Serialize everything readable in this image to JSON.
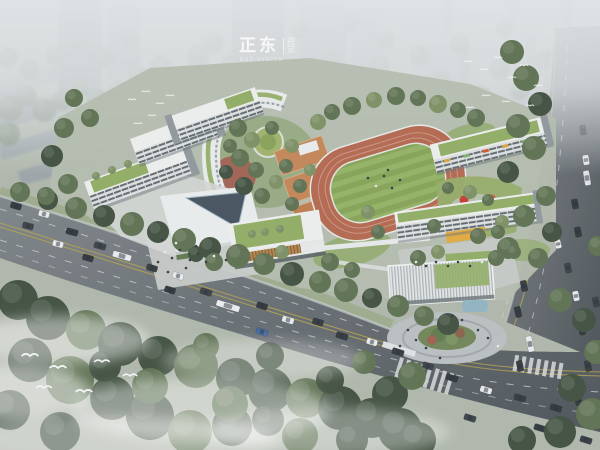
{
  "watermark": {
    "brand": "正东",
    "vertical": "视觉",
    "subtext": "EST VISION"
  },
  "palette": {
    "sky": "#c3cacd",
    "fog": "#e0e4e7",
    "ground": "#aeb6aa",
    "plinth": "#b4bcae",
    "road": "#7d8488",
    "roadDark": "#4b5257",
    "laneYellow": "#b7a14c",
    "laneWhite": "#cdd2d3",
    "trackRed": "#b4674f",
    "fieldGreenA": "#84a355",
    "fieldGreenB": "#93b165",
    "courtOrange": "#c28455",
    "roofGreen": "#8fac63",
    "buildingWhite": "#eceeee",
    "facadeShade": "#aab2b6",
    "windowDark": "#5f686e",
    "treeLight": "#7b8f62",
    "treeMid": "#5c7050",
    "treeDark": "#3f4f3f",
    "treeHaze": "#828e7e",
    "forest": "#42513e",
    "plazaRed": "#a3554b",
    "woodLouver": "#b5854c",
    "canopyYellow": "#e2a93e",
    "pondBlue": "#8fb3c2",
    "cityGrey": "#9aa2a7",
    "plaza": "#c3c8c7",
    "accentRed": "#c23b30"
  },
  "scene": {
    "trees_bg": [
      [
        10,
        108,
        13
      ],
      [
        26,
        96,
        11
      ],
      [
        44,
        110,
        12
      ],
      [
        8,
        134,
        12
      ],
      [
        62,
        100,
        10
      ],
      [
        80,
        88,
        10
      ],
      [
        98,
        100,
        11
      ],
      [
        118,
        90,
        10
      ],
      [
        140,
        78,
        11
      ],
      [
        160,
        66,
        10
      ],
      [
        178,
        84,
        10
      ],
      [
        198,
        56,
        11
      ],
      [
        214,
        44,
        10
      ],
      [
        232,
        64,
        10
      ],
      [
        252,
        40,
        9
      ],
      [
        270,
        56,
        9
      ],
      [
        300,
        72,
        10
      ],
      [
        330,
        60,
        10
      ],
      [
        355,
        84,
        10
      ],
      [
        380,
        66,
        10
      ],
      [
        400,
        90,
        11
      ],
      [
        420,
        56,
        10
      ],
      [
        440,
        80,
        10
      ],
      [
        300,
        30,
        9
      ],
      [
        350,
        22,
        9
      ],
      [
        460,
        44,
        10
      ],
      [
        480,
        96,
        11
      ],
      [
        500,
        70,
        10
      ],
      [
        520,
        90,
        10
      ],
      [
        545,
        60,
        10
      ],
      [
        250,
        90,
        10
      ],
      [
        225,
        100,
        10
      ],
      [
        130,
        40,
        9
      ],
      [
        105,
        58,
        10
      ],
      [
        80,
        40,
        9
      ],
      [
        55,
        56,
        9
      ],
      [
        30,
        70,
        10
      ],
      [
        8,
        58,
        10
      ],
      [
        385,
        40,
        9
      ],
      [
        505,
        28,
        9
      ],
      [
        596,
        140,
        10
      ],
      [
        592,
        176,
        10
      ]
    ],
    "trees": [
      [
        18,
        300,
        20,
        2
      ],
      [
        48,
        318,
        22,
        2
      ],
      [
        86,
        330,
        20,
        1
      ],
      [
        120,
        344,
        22,
        2
      ],
      [
        158,
        356,
        20,
        2
      ],
      [
        196,
        366,
        22,
        1
      ],
      [
        236,
        378,
        20,
        2
      ],
      [
        270,
        390,
        22,
        2
      ],
      [
        306,
        398,
        20,
        1
      ],
      [
        340,
        408,
        22,
        2
      ],
      [
        372,
        418,
        20,
        2
      ],
      [
        400,
        430,
        22,
        2
      ],
      [
        30,
        360,
        22,
        2
      ],
      [
        70,
        380,
        24,
        1
      ],
      [
        112,
        398,
        22,
        2
      ],
      [
        150,
        416,
        24,
        2
      ],
      [
        190,
        432,
        22,
        1
      ],
      [
        10,
        410,
        20,
        2
      ],
      [
        60,
        432,
        20,
        2
      ],
      [
        232,
        426,
        20,
        2
      ],
      [
        300,
        436,
        18,
        1
      ],
      [
        352,
        440,
        16,
        2
      ],
      [
        390,
        394,
        18,
        2
      ],
      [
        412,
        376,
        14,
        1
      ],
      [
        150,
        386,
        18,
        1
      ],
      [
        105,
        366,
        16,
        2
      ],
      [
        230,
        404,
        18,
        1
      ],
      [
        268,
        420,
        16,
        2
      ],
      [
        330,
        380,
        14,
        2
      ],
      [
        364,
        362,
        12,
        1
      ],
      [
        418,
        440,
        18,
        2
      ],
      [
        270,
        356,
        14,
        2
      ],
      [
        206,
        346,
        13,
        1
      ],
      [
        20,
        192,
        10,
        1
      ],
      [
        48,
        200,
        10,
        2
      ],
      [
        76,
        208,
        11,
        1
      ],
      [
        104,
        216,
        11,
        2
      ],
      [
        132,
        224,
        12,
        1
      ],
      [
        158,
        232,
        11,
        2
      ],
      [
        184,
        240,
        12,
        1
      ],
      [
        210,
        248,
        11,
        2
      ],
      [
        238,
        256,
        12,
        1
      ],
      [
        264,
        264,
        11,
        1
      ],
      [
        292,
        274,
        12,
        2
      ],
      [
        320,
        282,
        11,
        1
      ],
      [
        346,
        290,
        12,
        1
      ],
      [
        372,
        298,
        10,
        2
      ],
      [
        398,
        306,
        11,
        1
      ],
      [
        424,
        316,
        10,
        1
      ],
      [
        448,
        324,
        11,
        2
      ],
      [
        512,
        52,
        12,
        1
      ],
      [
        526,
        78,
        13,
        1
      ],
      [
        540,
        104,
        12,
        2
      ],
      [
        518,
        126,
        12,
        1
      ],
      [
        534,
        148,
        12,
        1
      ],
      [
        508,
        172,
        11,
        2
      ],
      [
        546,
        196,
        10,
        1
      ],
      [
        524,
        216,
        11,
        1
      ],
      [
        552,
        232,
        10,
        2
      ],
      [
        508,
        248,
        11,
        1
      ],
      [
        538,
        258,
        10,
        1
      ],
      [
        560,
        300,
        12,
        1
      ],
      [
        584,
        320,
        12,
        2
      ],
      [
        596,
        352,
        12,
        1
      ],
      [
        572,
        388,
        14,
        2
      ],
      [
        592,
        414,
        16,
        1
      ],
      [
        560,
        432,
        16,
        2
      ],
      [
        522,
        440,
        14,
        2
      ],
      [
        598,
        246,
        10,
        1
      ],
      [
        332,
        112,
        8,
        1
      ],
      [
        352,
        106,
        9,
        1
      ],
      [
        374,
        100,
        8,
        0
      ],
      [
        396,
        96,
        9,
        1
      ],
      [
        418,
        98,
        8,
        1
      ],
      [
        438,
        104,
        9,
        0
      ],
      [
        458,
        110,
        8,
        1
      ],
      [
        476,
        118,
        9,
        1
      ],
      [
        318,
        122,
        8,
        0
      ],
      [
        238,
        128,
        9,
        1
      ],
      [
        252,
        140,
        8,
        0
      ],
      [
        240,
        158,
        9,
        1
      ],
      [
        256,
        170,
        8,
        1
      ],
      [
        244,
        186,
        9,
        2
      ],
      [
        262,
        196,
        8,
        1
      ],
      [
        276,
        182,
        7,
        0
      ],
      [
        286,
        166,
        7,
        1
      ],
      [
        272,
        128,
        7,
        1
      ],
      [
        292,
        146,
        7,
        0
      ],
      [
        300,
        186,
        7,
        1
      ],
      [
        310,
        170,
        6,
        0
      ],
      [
        292,
        204,
        7,
        1
      ],
      [
        230,
        146,
        7,
        1
      ],
      [
        226,
        172,
        7,
        2
      ],
      [
        214,
        262,
        9,
        1
      ],
      [
        196,
        254,
        8,
        2
      ],
      [
        330,
        262,
        9,
        1
      ],
      [
        352,
        270,
        8,
        1
      ],
      [
        282,
        252,
        7,
        0
      ],
      [
        418,
        258,
        8,
        1
      ],
      [
        438,
        252,
        7,
        0
      ],
      [
        496,
        258,
        8,
        1
      ],
      [
        514,
        252,
        7,
        1
      ],
      [
        470,
        192,
        7,
        0
      ],
      [
        448,
        188,
        6,
        1
      ],
      [
        488,
        200,
        6,
        1
      ],
      [
        502,
        222,
        7,
        0
      ],
      [
        434,
        226,
        7,
        1
      ],
      [
        378,
        232,
        7,
        1
      ],
      [
        368,
        212,
        7,
        0
      ],
      [
        478,
        236,
        8,
        1
      ],
      [
        498,
        232,
        7,
        1
      ],
      [
        64,
        128,
        10,
        1
      ],
      [
        52,
        156,
        11,
        2
      ],
      [
        68,
        184,
        10,
        1
      ],
      [
        46,
        196,
        9,
        1
      ],
      [
        90,
        118,
        9,
        1
      ],
      [
        74,
        98,
        9,
        1
      ],
      [
        96,
        176,
        4,
        0
      ],
      [
        112,
        170,
        4,
        0
      ],
      [
        128,
        164,
        4,
        0
      ],
      [
        265,
        232,
        4,
        0
      ],
      [
        280,
        229,
        4,
        0
      ],
      [
        252,
        234,
        4,
        0
      ]
    ],
    "cars_far": [
      [
        583,
        130,
        10,
        82,
        "#3a4046"
      ],
      [
        586,
        160,
        10,
        81,
        "#e8eaec"
      ],
      [
        587,
        178,
        15,
        81,
        "#dfe3e5"
      ]
    ],
    "cars": [
      [
        16,
        206,
        11,
        15,
        "#2f353a"
      ],
      [
        44,
        214,
        11,
        15,
        "#e8eaec"
      ],
      [
        28,
        226,
        11,
        15,
        "#3a4046"
      ],
      [
        72,
        232,
        12,
        15,
        "#2f353a"
      ],
      [
        58,
        244,
        11,
        15,
        "#e8eaec"
      ],
      [
        100,
        246,
        12,
        16,
        "#3a4046"
      ],
      [
        88,
        258,
        11,
        16,
        "#2f353a"
      ],
      [
        122,
        256,
        19,
        16,
        "#e9ebec"
      ],
      [
        152,
        268,
        11,
        17,
        "#33393e"
      ],
      [
        178,
        276,
        11,
        17,
        "#e8eaec"
      ],
      [
        170,
        290,
        11,
        17,
        "#2f353a"
      ],
      [
        206,
        292,
        12,
        17,
        "#3a4046"
      ],
      [
        228,
        306,
        24,
        17,
        "#eceeef"
      ],
      [
        262,
        306,
        11,
        17,
        "#2f353a"
      ],
      [
        288,
        320,
        12,
        17,
        "#e8eaec"
      ],
      [
        262,
        332,
        12,
        17,
        "#3f65a0"
      ],
      [
        318,
        322,
        11,
        17,
        "#33393e"
      ],
      [
        342,
        336,
        12,
        17,
        "#2f353a"
      ],
      [
        372,
        342,
        11,
        17,
        "#e8eaec"
      ],
      [
        398,
        352,
        12,
        17,
        "#33393e"
      ],
      [
        368,
        364,
        12,
        17,
        "#2f353a"
      ],
      [
        428,
        366,
        11,
        17,
        "#3a4046"
      ],
      [
        452,
        378,
        12,
        18,
        "#2f353a"
      ],
      [
        486,
        390,
        12,
        18,
        "#e8eaec"
      ],
      [
        520,
        398,
        12,
        18,
        "#33393e"
      ],
      [
        556,
        408,
        12,
        18,
        "#2f353a"
      ],
      [
        470,
        418,
        12,
        18,
        "#3a4046"
      ],
      [
        540,
        428,
        12,
        18,
        "#2f353a"
      ],
      [
        586,
        440,
        12,
        18,
        "#33393e"
      ],
      [
        524,
        286,
        11,
        78,
        "#33393e"
      ],
      [
        518,
        312,
        11,
        78,
        "#2f353a"
      ],
      [
        530,
        344,
        16,
        78,
        "#e9ebec"
      ],
      [
        520,
        366,
        11,
        78,
        "#33393e"
      ],
      [
        568,
        268,
        10,
        79,
        "#3a4046"
      ],
      [
        576,
        296,
        10,
        79,
        "#e8eaec"
      ],
      [
        582,
        330,
        10,
        78,
        "#2f353a"
      ],
      [
        588,
        366,
        11,
        78,
        "#33393e"
      ],
      [
        578,
        400,
        11,
        77,
        "#2f353a"
      ],
      [
        596,
        302,
        10,
        78,
        "#3a4046"
      ],
      [
        575,
        204,
        10,
        80,
        "#32383d"
      ],
      [
        578,
        232,
        10,
        79,
        "#2f353a"
      ],
      [
        558,
        244,
        9,
        76,
        "#e8eaec"
      ]
    ],
    "birds": [
      [
        132,
        100,
        0.7
      ],
      [
        146,
        92,
        0.7
      ],
      [
        160,
        104,
        0.7
      ],
      [
        170,
        96,
        0.7
      ],
      [
        152,
        116,
        0.7
      ],
      [
        138,
        124,
        0.7
      ],
      [
        468,
        62,
        0.7
      ],
      [
        484,
        70,
        0.7
      ],
      [
        498,
        58,
        0.7
      ],
      [
        512,
        78,
        0.7
      ],
      [
        524,
        66,
        0.7
      ],
      [
        538,
        86,
        0.7
      ],
      [
        486,
        96,
        0.7
      ],
      [
        506,
        102,
        0.7
      ],
      [
        470,
        108,
        0.7
      ],
      [
        530,
        106,
        0.7
      ],
      [
        30,
        356,
        1.4
      ],
      [
        58,
        368,
        1.4
      ],
      [
        102,
        362,
        1.3
      ],
      [
        84,
        392,
        1.4
      ],
      [
        130,
        376,
        1.2
      ],
      [
        44,
        388,
        1.3
      ]
    ],
    "people": [
      [
        165,
        252
      ],
      [
        172,
        258
      ],
      [
        180,
        250
      ],
      [
        190,
        260
      ],
      [
        198,
        254
      ],
      [
        206,
        262
      ],
      [
        214,
        256
      ],
      [
        158,
        262
      ],
      [
        186,
        268
      ],
      [
        226,
        260
      ],
      [
        150,
        270
      ],
      [
        168,
        272
      ],
      [
        416,
        262
      ],
      [
        426,
        266
      ],
      [
        436,
        262
      ],
      [
        448,
        266
      ],
      [
        458,
        262
      ],
      [
        470,
        266
      ],
      [
        482,
        262
      ],
      [
        408,
        330
      ],
      [
        416,
        340
      ],
      [
        426,
        348
      ],
      [
        478,
        330
      ],
      [
        488,
        338
      ],
      [
        498,
        346
      ],
      [
        452,
        316
      ],
      [
        462,
        320
      ],
      [
        400,
        346
      ],
      [
        440,
        358
      ],
      [
        368,
        178
      ],
      [
        376,
        186
      ],
      [
        384,
        176
      ],
      [
        392,
        188
      ],
      [
        400,
        180
      ],
      [
        388,
        170
      ],
      [
        162,
        240
      ],
      [
        176,
        243
      ],
      [
        196,
        246
      ]
    ],
    "crosswalks": [
      {
        "x": 424,
        "y": 376,
        "rot": 17,
        "n": 8,
        "step": 7.5,
        "len": 22
      },
      {
        "x": 538,
        "y": 367,
        "rot": 10,
        "n": 7,
        "step": 7.5,
        "len": 16
      }
    ]
  }
}
